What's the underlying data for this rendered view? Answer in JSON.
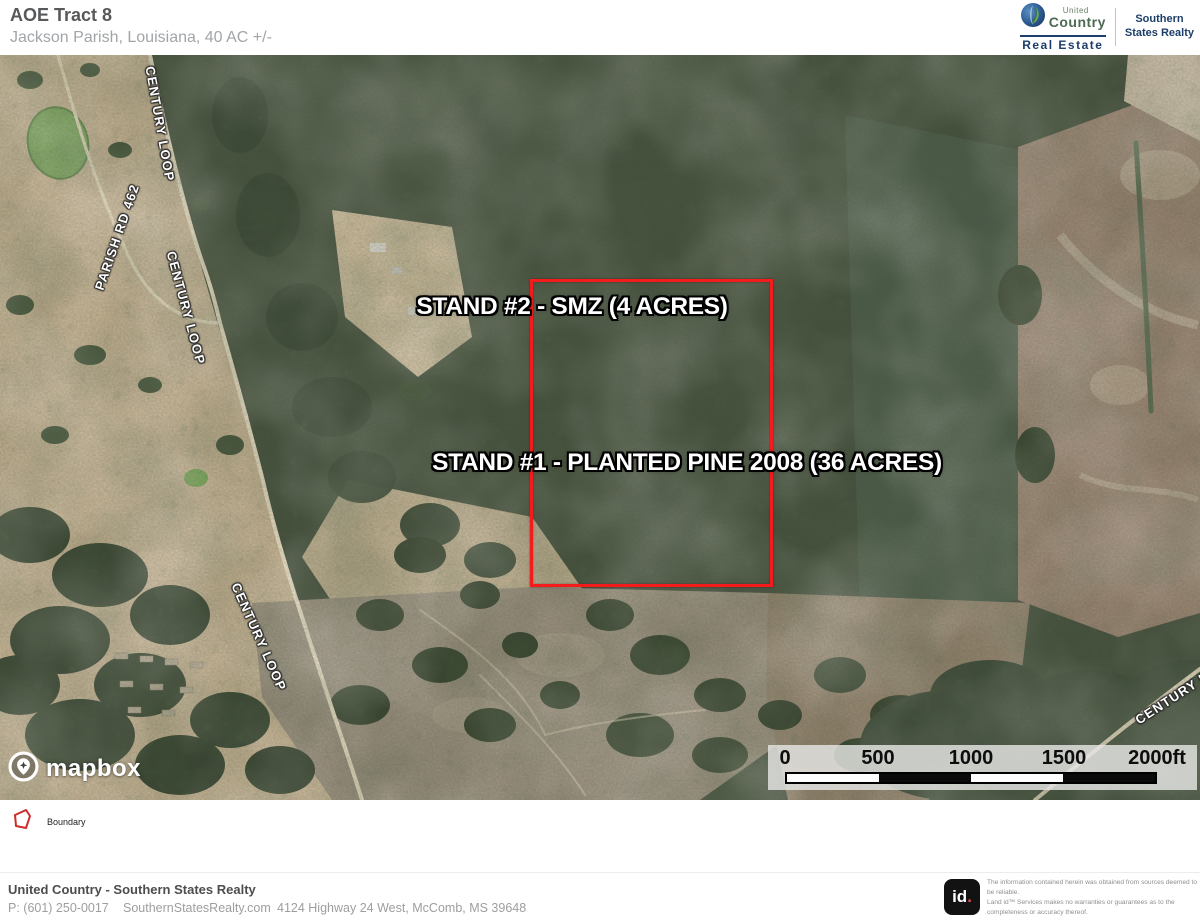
{
  "colors": {
    "boundary_red": "#f31b1b",
    "legend_red": "#cf2b2b",
    "brand_navy": "#1d3e6a",
    "uc_green": "#4e6a52",
    "title_gray": "#58595b",
    "subtitle_gray": "#a2a5a8",
    "id_dot_red": "#e5484d"
  },
  "header": {
    "title": "AOE Tract 8",
    "subtitle": "Jackson Parish, Louisiana, 40 AC +/-",
    "uc_logo": {
      "united": "United",
      "country": "Country",
      "real_estate": "Real Estate"
    },
    "partner": {
      "line1": "Southern",
      "line2": "States Realty"
    }
  },
  "map": {
    "stand_labels": [
      {
        "text": "STAND #2 - SMZ (4 ACRES)"
      },
      {
        "text": "STAND #1 - PLANTED PINE 2008 (36 ACRES)"
      }
    ],
    "road_labels": [
      {
        "text": "CENTURY LOOP"
      },
      {
        "text": "PARISH RD 462"
      },
      {
        "text": "CENTURY LOOP"
      },
      {
        "text": "CENTURY LOOP"
      },
      {
        "text": "CENTURY L"
      }
    ],
    "attribution": "mapbox",
    "scale_bar": {
      "ticks": [
        "0",
        "500",
        "1000",
        "1500",
        "2000ft"
      ]
    }
  },
  "legend": {
    "items": [
      {
        "label": "Boundary"
      }
    ]
  },
  "footer": {
    "company": "United Country - Southern States Realty",
    "phone": "P: (601) 250-0017",
    "website": "SouthernStatesRealty.com",
    "address": "4124 Highway 24 West, McComb, MS 39648",
    "logo_text": "id",
    "logo_dot": ".",
    "disclaimer_line1": "The information contained herein was obtained from sources deemed to be reliable.",
    "disclaimer_line2": "Land id™ Services makes no warranties or guarantees as to the completeness or accuracy thereof."
  }
}
